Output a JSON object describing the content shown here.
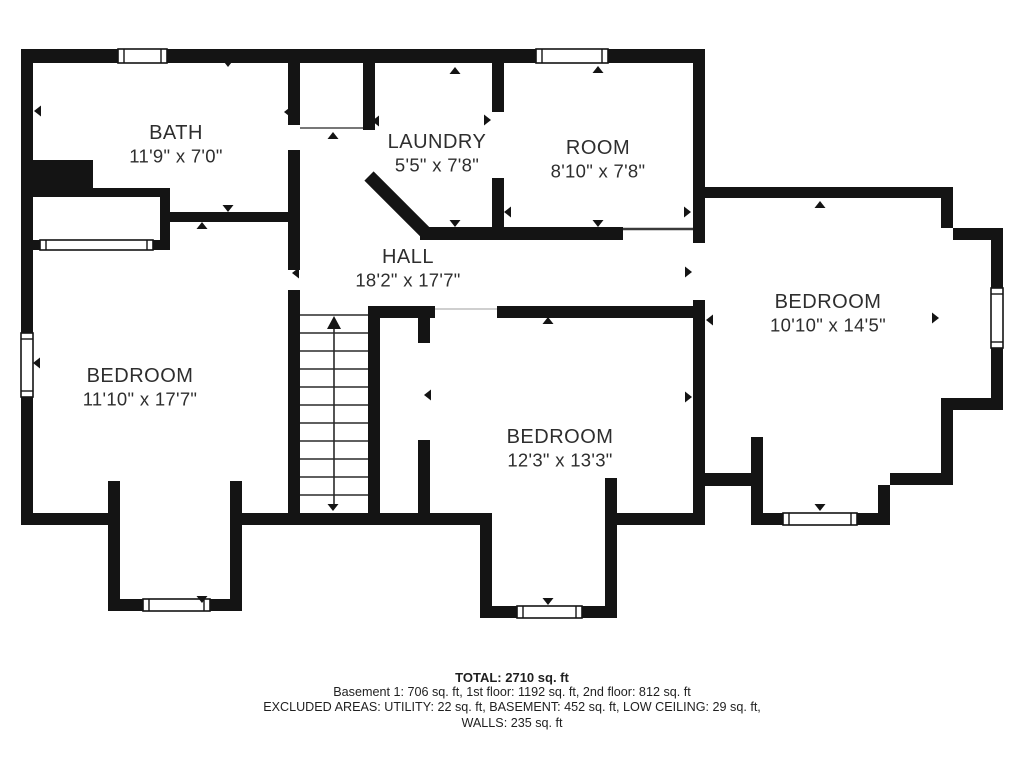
{
  "footer": {
    "total": "TOTAL: 2710 sq. ft",
    "floors": "Basement 1: 706 sq. ft, 1st floor: 1192 sq. ft, 2nd floor: 812 sq. ft",
    "excluded": "EXCLUDED AREAS: UTILITY: 22 sq. ft, BASEMENT: 452 sq. ft, LOW CEILING: 29 sq. ft,",
    "walls_line": "WALLS: 235 sq. ft"
  },
  "colors": {
    "wall": "#141414",
    "text": "#2e2e2e",
    "bg": "#ffffff",
    "window_fill": "#ffffff",
    "corridor_line": "#777777",
    "door_line": "#cfcfcf",
    "open_line": "#3a3a3a",
    "step_line": "#2a2a2a"
  },
  "rooms": [
    {
      "name": "BATH",
      "dims": "11'9\" x 7'0\"",
      "cx": 176,
      "cy": 133
    },
    {
      "name": "LAUNDRY",
      "dims": "5'5\" x 7'8\"",
      "cx": 437,
      "cy": 142
    },
    {
      "name": "ROOM",
      "dims": "8'10\" x 7'8\"",
      "cx": 598,
      "cy": 148
    },
    {
      "name": "HALL",
      "dims": "18'2\" x 17'7\"",
      "cx": 408,
      "cy": 257
    },
    {
      "name": "BEDROOM",
      "dims": "11'10\" x 17'7\"",
      "cx": 140,
      "cy": 376
    },
    {
      "name": "BEDROOM",
      "dims": "10'10\" x 14'5\"",
      "cx": 828,
      "cy": 302
    },
    {
      "name": "BEDROOM",
      "dims": "12'3\" x 13'3\"",
      "cx": 560,
      "cy": 437
    }
  ],
  "plan": {
    "walls": [
      [
        21,
        49,
        684,
        14
      ],
      [
        21,
        49,
        12,
        476
      ],
      [
        28,
        160,
        65,
        28
      ],
      [
        28,
        188,
        142,
        9
      ],
      [
        160,
        197,
        10,
        53
      ],
      [
        28,
        240,
        142,
        10
      ],
      [
        170,
        212,
        130,
        10
      ],
      [
        288,
        63,
        12,
        62
      ],
      [
        288,
        150,
        12,
        120
      ],
      [
        288,
        290,
        12,
        235
      ],
      [
        363,
        63,
        12,
        67
      ],
      [
        420,
        227,
        203,
        13
      ],
      [
        492,
        63,
        12,
        49
      ],
      [
        492,
        178,
        12,
        62
      ],
      [
        693,
        63,
        12,
        180
      ],
      [
        693,
        300,
        12,
        225
      ],
      [
        705,
        187,
        248,
        11
      ],
      [
        941,
        198,
        12,
        30
      ],
      [
        953,
        228,
        50,
        12
      ],
      [
        991,
        240,
        12,
        170
      ],
      [
        953,
        398,
        50,
        12
      ],
      [
        941,
        398,
        12,
        87
      ],
      [
        890,
        473,
        63,
        12
      ],
      [
        878,
        485,
        12,
        40
      ],
      [
        857,
        513,
        33,
        12
      ],
      [
        751,
        513,
        32,
        12
      ],
      [
        751,
        437,
        12,
        88
      ],
      [
        705,
        473,
        46,
        13
      ],
      [
        368,
        306,
        67,
        12
      ],
      [
        497,
        306,
        198,
        12
      ],
      [
        418,
        318,
        12,
        25
      ],
      [
        418,
        440,
        12,
        73
      ],
      [
        368,
        306,
        12,
        207
      ],
      [
        242,
        513,
        238,
        12
      ],
      [
        21,
        513,
        87,
        12
      ],
      [
        108,
        481,
        12,
        130
      ],
      [
        230,
        481,
        12,
        130
      ],
      [
        120,
        599,
        23,
        12
      ],
      [
        210,
        599,
        20,
        12
      ],
      [
        480,
        513,
        12,
        105
      ],
      [
        605,
        478,
        12,
        140
      ],
      [
        492,
        606,
        25,
        12
      ],
      [
        582,
        606,
        23,
        12
      ],
      [
        617,
        513,
        88,
        12
      ]
    ],
    "diagonals": [
      [
        369,
        176,
        427,
        234,
        13
      ]
    ],
    "windows": [
      {
        "x": 118,
        "y": 49,
        "w": 49,
        "h": 14,
        "o": "h"
      },
      {
        "x": 536,
        "y": 49,
        "w": 72,
        "h": 14,
        "o": "h"
      },
      {
        "x": 21,
        "y": 333,
        "w": 12,
        "h": 64,
        "o": "v"
      },
      {
        "x": 40,
        "y": 240,
        "w": 113,
        "h": 10,
        "o": "h"
      },
      {
        "x": 991,
        "y": 288,
        "w": 12,
        "h": 60,
        "o": "v"
      },
      {
        "x": 783,
        "y": 513,
        "w": 74,
        "h": 12,
        "o": "h"
      },
      {
        "x": 143,
        "y": 599,
        "w": 67,
        "h": 12,
        "o": "h"
      },
      {
        "x": 517,
        "y": 606,
        "w": 65,
        "h": 12,
        "o": "h"
      }
    ],
    "thin_lines": [
      {
        "x1": 300,
        "y1": 128,
        "x2": 363,
        "y2": 128,
        "c": "corridor_line",
        "w": 2
      },
      {
        "x1": 435,
        "y1": 309,
        "x2": 497,
        "y2": 309,
        "c": "door_line",
        "w": 2
      },
      {
        "x1": 623,
        "y1": 229,
        "x2": 693,
        "y2": 229,
        "c": "open_line",
        "w": 2.5
      }
    ],
    "stairs": {
      "x1": 300,
      "x2": 368,
      "top": 315,
      "bottom": 513,
      "step": 18,
      "center_x": 334,
      "arrow_apex_y": 316,
      "line_bottom_y": 507
    },
    "openings": [
      {
        "x": 228,
        "y": 67,
        "d": "down"
      },
      {
        "x": 34,
        "y": 111,
        "d": "left"
      },
      {
        "x": 284,
        "y": 112,
        "d": "left"
      },
      {
        "x": 333,
        "y": 132,
        "d": "up"
      },
      {
        "x": 372,
        "y": 121,
        "d": "left"
      },
      {
        "x": 455,
        "y": 67,
        "d": "up"
      },
      {
        "x": 491,
        "y": 120,
        "d": "right"
      },
      {
        "x": 598,
        "y": 66,
        "d": "up"
      },
      {
        "x": 504,
        "y": 212,
        "d": "left"
      },
      {
        "x": 691,
        "y": 212,
        "d": "right"
      },
      {
        "x": 598,
        "y": 227,
        "d": "down"
      },
      {
        "x": 228,
        "y": 212,
        "d": "down"
      },
      {
        "x": 202,
        "y": 222,
        "d": "up"
      },
      {
        "x": 33,
        "y": 363,
        "d": "left"
      },
      {
        "x": 292,
        "y": 273,
        "d": "left"
      },
      {
        "x": 820,
        "y": 201,
        "d": "up"
      },
      {
        "x": 692,
        "y": 272,
        "d": "right"
      },
      {
        "x": 706,
        "y": 320,
        "d": "left"
      },
      {
        "x": 692,
        "y": 397,
        "d": "right"
      },
      {
        "x": 548,
        "y": 317,
        "d": "up"
      },
      {
        "x": 424,
        "y": 395,
        "d": "left"
      },
      {
        "x": 333,
        "y": 511,
        "d": "down"
      },
      {
        "x": 202,
        "y": 603,
        "d": "down"
      },
      {
        "x": 548,
        "y": 605,
        "d": "down"
      },
      {
        "x": 820,
        "y": 511,
        "d": "down"
      },
      {
        "x": 939,
        "y": 318,
        "d": "right"
      },
      {
        "x": 455,
        "y": 227,
        "d": "down"
      }
    ]
  }
}
